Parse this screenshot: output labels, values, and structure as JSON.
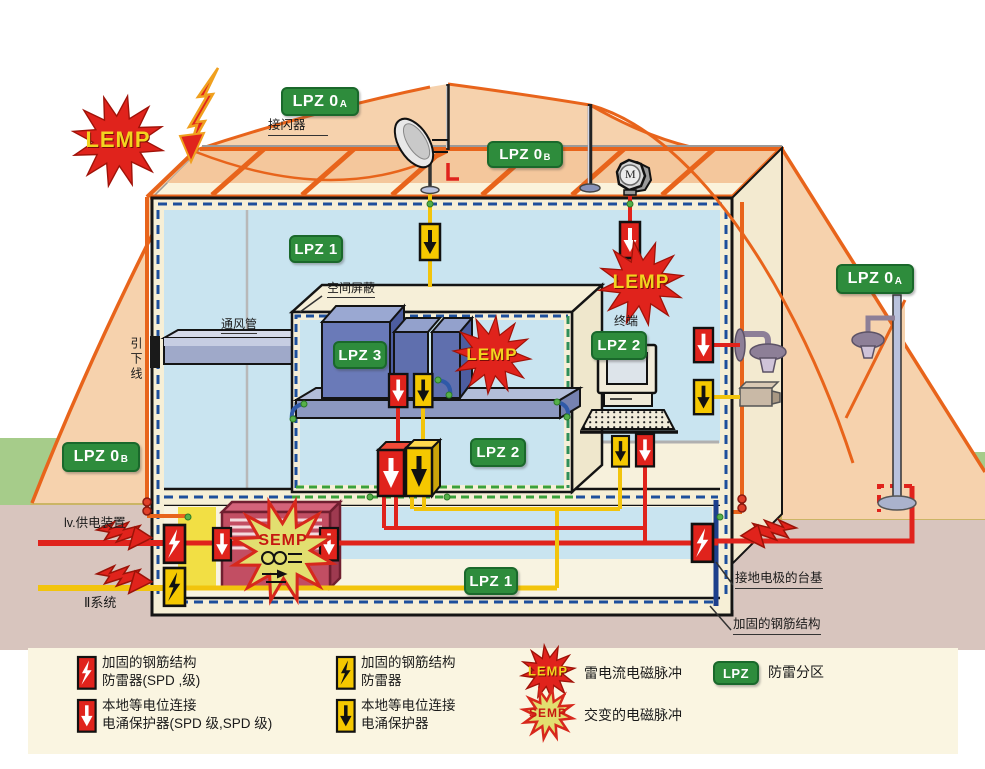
{
  "badges": {
    "b1": {
      "text": "LPZ 0",
      "sub": "A"
    },
    "b2": {
      "text": "LPZ 0",
      "sub": "B"
    },
    "b3": {
      "text": "LPZ 0",
      "sub": "A"
    },
    "b4": {
      "text": "LPZ 0",
      "sub": "B"
    },
    "b5": {
      "text": "LPZ 1"
    },
    "b6": {
      "text": "LPZ 1"
    },
    "b7": {
      "text": "LPZ 2"
    },
    "b8": {
      "text": "LPZ 2"
    },
    "b9": {
      "text": "LPZ 3"
    }
  },
  "stars": {
    "lemp": "LEMP",
    "semp": "SEMP"
  },
  "labels": {
    "air_terminal": "接闪器",
    "spatial_shield": "空间屏蔽",
    "vent_duct": "通风管",
    "down_conductor": "引下线",
    "terminal": "终端",
    "lv_supply": "lv.供电装置",
    "system_ii": "Ⅱ系统",
    "foundation_electrode": "接地电极的台基",
    "reinforced_steel": "加固的钢筋结构",
    "motor": "M"
  },
  "legend": {
    "spd_red_lightning": {
      "line1": "加固的钢筋结构",
      "line2": "防雷器(SPD ,级)"
    },
    "spd_red_arrow": {
      "line1": "本地等电位连接",
      "line2": "电涌保护器(SPD 级,SPD 级)"
    },
    "spd_yellow_lightning": {
      "line1": "加固的钢筋结构",
      "line2": "防雷器"
    },
    "spd_yellow_arrow": {
      "line1": "本地等电位连接",
      "line2": "电涌保护器"
    },
    "lemp": {
      "label": "LEMP",
      "text": "雷电流电磁脉冲"
    },
    "semp": {
      "label": "SEMP",
      "text": "交变的电磁脉冲"
    },
    "lpz": {
      "label": "LPZ",
      "text": "防雷分区"
    }
  },
  "colors": {
    "zone_badge_green": "#2e8c3c",
    "lemp_red": "#e0231c",
    "semp_fill_yellow": "#e2df70",
    "spd_yellow": "#f5c800",
    "wire_red": "#e0231c",
    "wire_yellow": "#f2c40c",
    "conductor_orange": "#e8641b",
    "shield_dash_blue": "#1d4f9c",
    "bonding_dash_green": "#3aa13a",
    "protection_zone_peach": "#f6d2ad"
  }
}
